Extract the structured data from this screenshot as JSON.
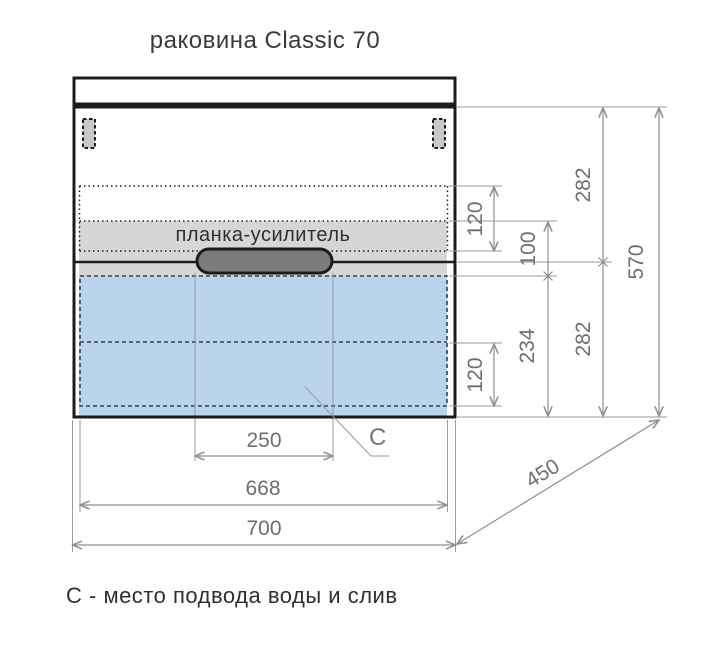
{
  "title": "раковина Classic 70",
  "caption": "С - место подвода воды и слив",
  "cabinet": {
    "reinforcement_label": "планка-усилитель",
    "connection_label": "С"
  },
  "dimensions": {
    "total_width": "700",
    "inner_width": "668",
    "handle_width": "250",
    "depth": "450",
    "total_height": "570",
    "upper_section_height": "282",
    "lower_section_height": "282",
    "sink_zone_height": "120",
    "drawer_zone_height": "120",
    "bar_zone_height": "100",
    "drawer_height": "234"
  },
  "colors": {
    "outline": "#1c1c1c",
    "drawer_fill": "#b9d3ec",
    "bar_fill": "#d6d6d6",
    "handle_fill": "#7c7c7c",
    "bracket_fill": "#c8c8c8",
    "dim_line": "#8f8f8f",
    "dim_text": "#6e6e6e"
  }
}
